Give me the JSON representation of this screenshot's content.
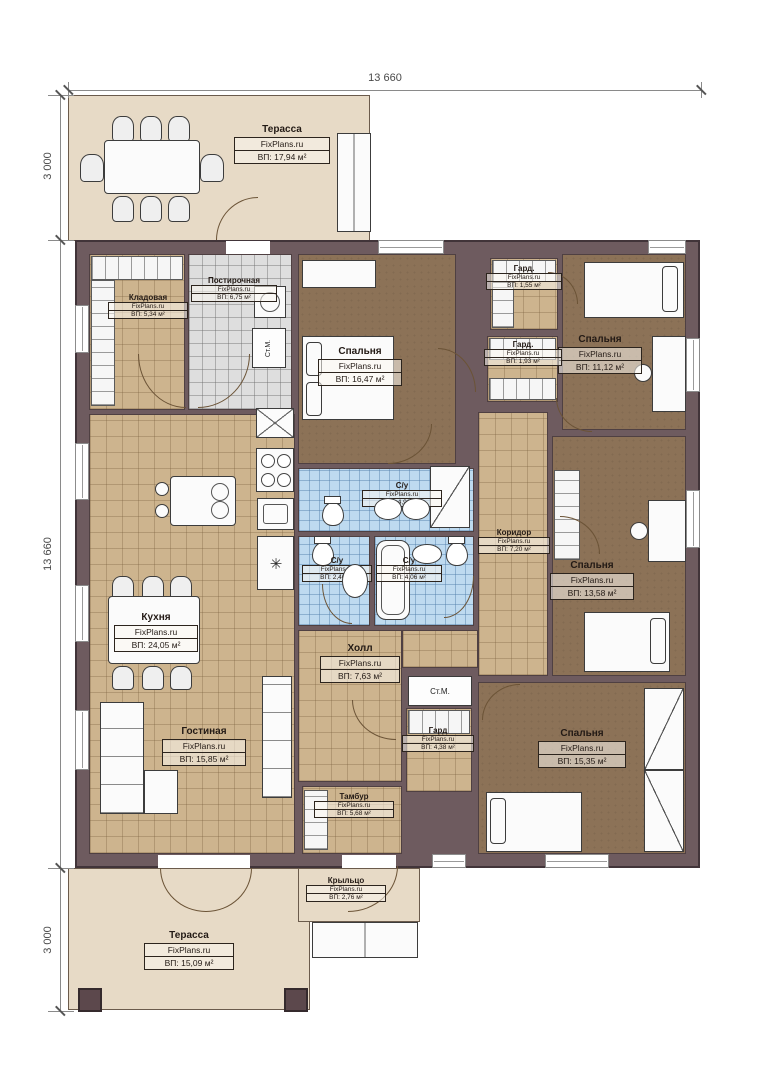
{
  "brand": "FixPlans.ru",
  "dims": {
    "top": "13 660",
    "left_top": "3 000",
    "left_main": "13 660",
    "left_bottom": "3 000"
  },
  "labels": {
    "washer": "Ст.М."
  },
  "icons": {
    "fridge": "✳"
  },
  "rooms": [
    {
      "name": "Терасса",
      "area": "ВП: 17,94 м²"
    },
    {
      "name": "Кладовая",
      "area": "ВП: 5,34 м²"
    },
    {
      "name": "Постирочная",
      "area": "ВП: 6,75 м²"
    },
    {
      "name": "Спальня",
      "area": "ВП: 16,47 м²"
    },
    {
      "name": "Гард.",
      "area": "ВП: 1,55 м²"
    },
    {
      "name": "Спальня",
      "area": "ВП: 11,12 м²"
    },
    {
      "name": "Гард.",
      "area": "ВП: 1,93 м²"
    },
    {
      "name": "С/у",
      "area": "ВП: 4,96 м²"
    },
    {
      "name": "Коридор",
      "area": "ВП: 7,20 м²"
    },
    {
      "name": "С/у",
      "area": "ВП: 2,46 м²"
    },
    {
      "name": "С/у",
      "area": "ВП: 4,06 м²"
    },
    {
      "name": "Спальня",
      "area": "ВП: 13,58 м²"
    },
    {
      "name": "Кухня",
      "area": "ВП: 24,05 м²"
    },
    {
      "name": "Холл",
      "area": "ВП: 7,63 м²"
    },
    {
      "name": "Гостиная",
      "area": "ВП: 15,85 м²"
    },
    {
      "name": "Гард",
      "area": "ВП: 4,38 м²"
    },
    {
      "name": "Спальня",
      "area": "ВП: 15,35 м²"
    },
    {
      "name": "Тамбур",
      "area": "ВП: 5,68 м²"
    },
    {
      "name": "Крыльцо",
      "area": "ВП: 2,76 м²"
    },
    {
      "name": "Терасса",
      "area": "ВП: 15,09 м²"
    }
  ]
}
